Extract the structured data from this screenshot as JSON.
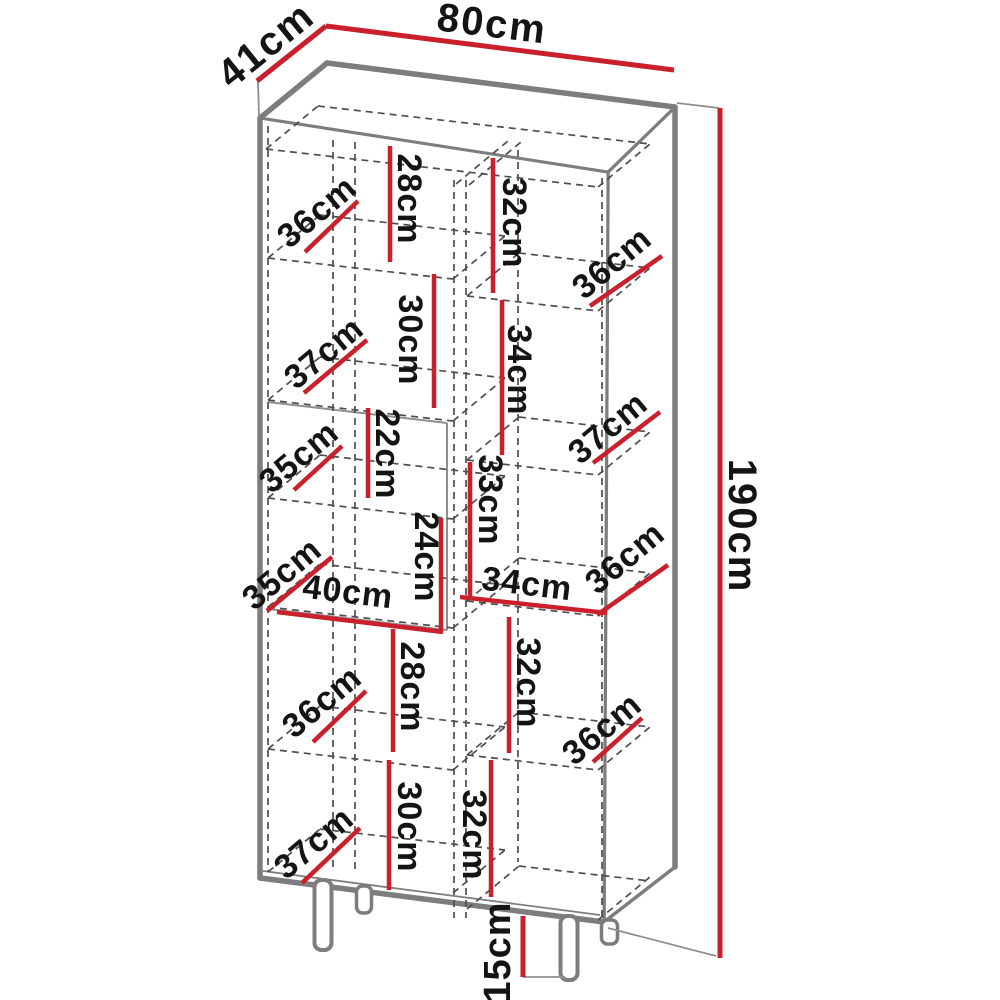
{
  "figure": {
    "type": "furniture-dimension-diagram",
    "subject": "tall two-column display cabinet with legs"
  },
  "colors": {
    "dimension_red": "#c9202c",
    "outline_gray": "#7d7d7d",
    "dash_gray": "#4f4f4f",
    "label_black": "#141414",
    "background": "#ffffff"
  },
  "labels": {
    "k41": {
      "text": "41cm"
    },
    "k80": {
      "text": "80cm"
    },
    "k190": {
      "text": "190cm"
    },
    "k15": {
      "text": "15cm"
    },
    "l36a": {
      "text": "36cm"
    },
    "l28a": {
      "text": "28cm"
    },
    "r32a": {
      "text": "32cm"
    },
    "r36a": {
      "text": "36cm"
    },
    "l37a": {
      "text": "37cm"
    },
    "l30a": {
      "text": "30cm"
    },
    "r34a": {
      "text": "34cm"
    },
    "r37a": {
      "text": "37cm"
    },
    "l35a": {
      "text": "35cm"
    },
    "l22": {
      "text": "22cm"
    },
    "r33": {
      "text": "33cm"
    },
    "l35b": {
      "text": "35cm"
    },
    "l40": {
      "text": "40cm"
    },
    "l24": {
      "text": "24cm"
    },
    "r34b": {
      "text": "34cm"
    },
    "r36b": {
      "text": "36cm"
    },
    "l36b": {
      "text": "36cm"
    },
    "l28b": {
      "text": "28cm"
    },
    "r32b": {
      "text": "32cm"
    },
    "r36c": {
      "text": "36cm"
    },
    "l37b": {
      "text": "37cm"
    },
    "l30b": {
      "text": "30cm"
    },
    "r32c": {
      "text": "32cm"
    }
  }
}
